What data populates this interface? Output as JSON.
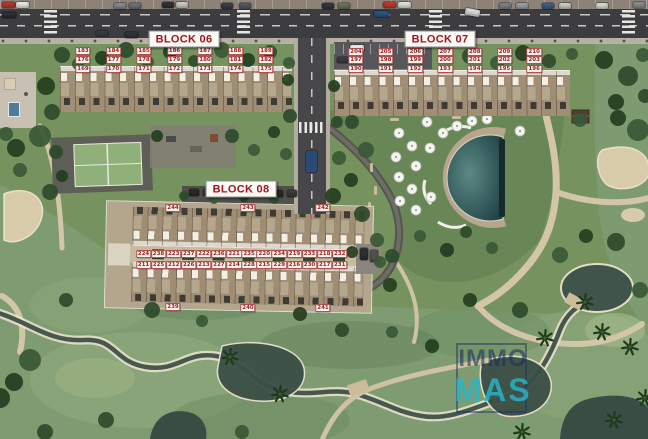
{
  "blocks": [
    {
      "id": "06",
      "title": "BLOCK 06",
      "rows": [
        [
          "183",
          "184",
          "185",
          "186",
          "187",
          "188",
          "189"
        ],
        [
          "176",
          "177",
          "178",
          "179",
          "180",
          "181",
          "182"
        ],
        [
          "169",
          "170",
          "171",
          "172",
          "173",
          "174",
          "175"
        ]
      ]
    },
    {
      "id": "07",
      "title": "BLOCK 07",
      "rows": [
        [
          "204",
          "205",
          "206",
          "207",
          "208",
          "209",
          "210"
        ],
        [
          "197",
          "198",
          "199",
          "200",
          "201",
          "202",
          "203"
        ],
        [
          "190",
          "191",
          "192",
          "193",
          "194",
          "195",
          "196"
        ]
      ]
    },
    {
      "id": "08",
      "title": "BLOCK 08",
      "top_edge": [
        "244",
        "243",
        "242"
      ],
      "bottom_edge": [
        "239",
        "240",
        "241"
      ],
      "street_upper": [
        [
          "224",
          "238"
        ],
        [
          "223",
          "237"
        ],
        [
          "222",
          "236"
        ],
        [
          "221",
          "235"
        ],
        [
          "220",
          "234"
        ],
        [
          "219",
          "233"
        ],
        [
          "218",
          "232"
        ]
      ],
      "street_lower": [
        [
          "211",
          "225"
        ],
        [
          "212",
          "226"
        ],
        [
          "213",
          "227"
        ],
        [
          "214",
          "228"
        ],
        [
          "215",
          "229"
        ],
        [
          "216",
          "230"
        ],
        [
          "217",
          "231"
        ]
      ]
    }
  ],
  "watermark": {
    "line1": "IMMO",
    "line2": "MAS"
  },
  "colors": {
    "label_red": "#9e1b1f",
    "title_red": "#a31418",
    "watermark_navy": "#1c305a",
    "watermark_teal": "#24b6cd",
    "pool_water": "#2e5a60"
  }
}
